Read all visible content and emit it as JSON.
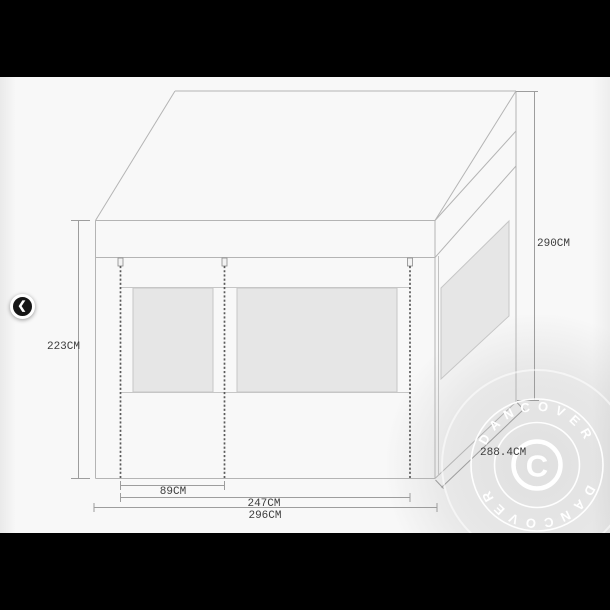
{
  "carousel": {
    "prev_icon": "❮"
  },
  "diagram": {
    "dimensions": {
      "side_height": "223CM",
      "total_height": "290CM",
      "side_depth": "288.4CM",
      "door_width": "89CM",
      "front_opening_width": "247CM",
      "total_width": "296CM"
    }
  },
  "watermark": {
    "arc_text_top": "DANCOVER",
    "arc_text_bottom": "DANCOVER",
    "center_letter": "C"
  },
  "colors": {
    "letterbox": "#000000",
    "canvas_background": "#f8f8f8",
    "outline": "#b4b4b4",
    "dimension_line": "#9d9d9d",
    "label_text": "#3c3c3c",
    "window_fill": "#e6e6e6",
    "zipper": "#5a5a5a",
    "watermark": "#ffffff",
    "nav_button": "#161616"
  }
}
